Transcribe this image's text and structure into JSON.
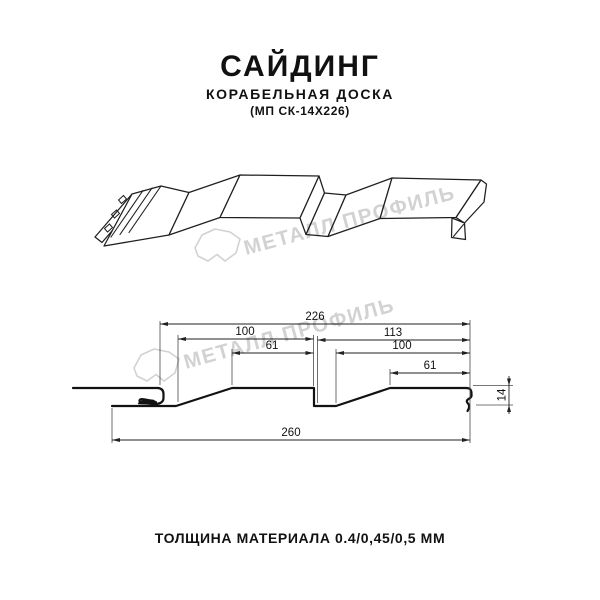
{
  "header": {
    "title": "САЙДИНГ",
    "subtitle": "КОРАБЕЛЬНАЯ ДОСКА",
    "product_code": "(МП СК-14Х226)"
  },
  "watermark": {
    "brand": "МЕТАЛЛ ПРОФИЛЬ",
    "logo_icon": "metall-profil-gem-logo",
    "color": "#d2d2d2"
  },
  "drawing": {
    "views": [
      "perspective-profile",
      "cross-section"
    ],
    "dimensions": {
      "overall_top": "226",
      "left_pitch": "100",
      "left_flat": "61",
      "right_pitch": "113",
      "right_inner": "100",
      "right_flat": "61",
      "profile_height": "14",
      "total_width": "260"
    },
    "line_color": "#1a1a1a"
  },
  "footer": {
    "thickness_note": "ТОЛЩИНА МАТЕРИАЛА 0.4/0,45/0,5 ММ"
  }
}
